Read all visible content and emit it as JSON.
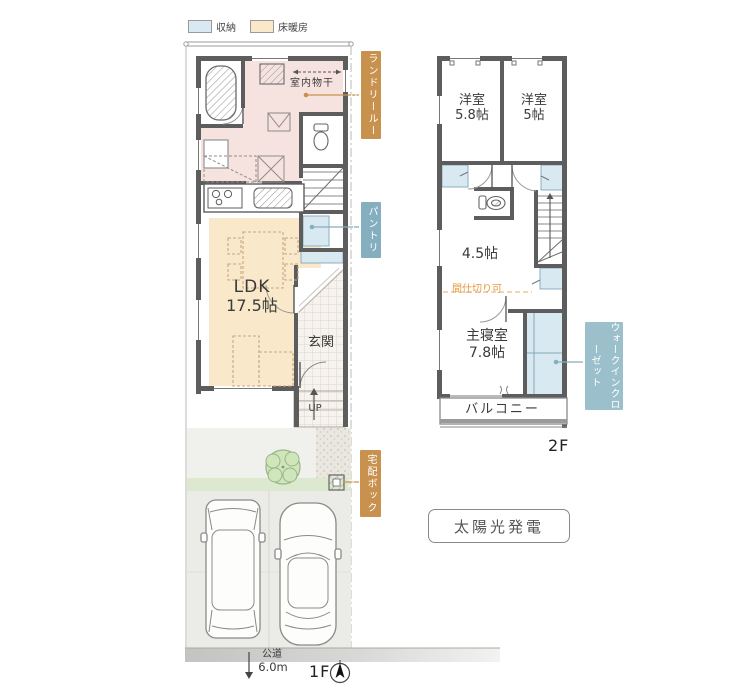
{
  "legend": {
    "items": [
      {
        "label": "収納",
        "color": "#d8e9f2"
      },
      {
        "label": "床暖房",
        "color": "#f9e8c9"
      }
    ]
  },
  "floor1": {
    "floor_label": "1F",
    "indoor_drying": "室内物干",
    "ldk_name": "LDK",
    "ldk_size": "17.5帖",
    "genkan": "玄関",
    "up_label": "UP",
    "callouts": {
      "laundry_room": "ランドリールーム",
      "pantry": "パントリー",
      "delivery_box": "宅配ボックス"
    },
    "road": {
      "name": "公道",
      "width": "6.0m"
    }
  },
  "floor2": {
    "floor_label": "2F",
    "rooms": {
      "bedroom1_name": "洋室",
      "bedroom1_size": "5.8帖",
      "bedroom2_name": "洋室",
      "bedroom2_size": "5帖",
      "free_room_size": "4.5帖",
      "master_name": "主寝室",
      "master_size": "7.8帖",
      "balcony": "バルコニー"
    },
    "partition_note": "間仕切り可",
    "callouts": {
      "walk_in_closet": "ウォークインクローゼット"
    }
  },
  "solar_label": "太陽光発電",
  "colors": {
    "storage_fill": "#d8e9f2",
    "floor_heating_fill": "#f9e8c9",
    "laundry_room_fill": "#f6e3e0",
    "callout_orange": "#c8914d",
    "callout_blue": "#85aebf",
    "wic_label_blue": "#9cc0cb",
    "partition_text": "#e59a43",
    "wall": "#5d5d5d"
  }
}
